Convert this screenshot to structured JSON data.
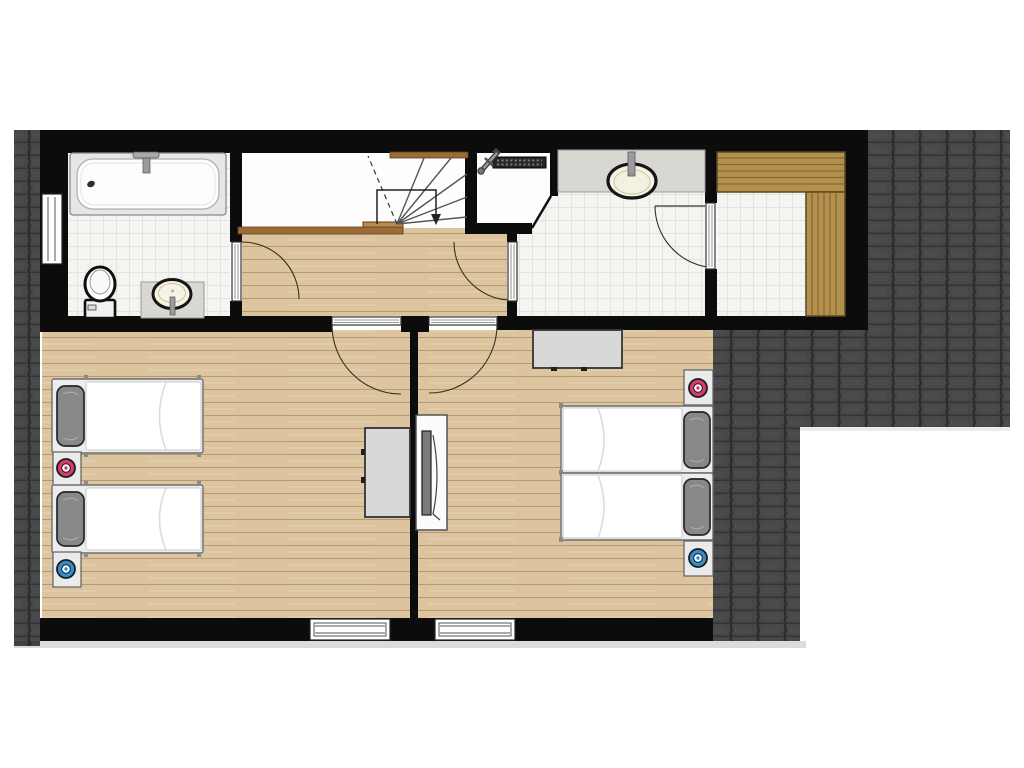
{
  "title": "Upper floor plan",
  "colors": {
    "wall": "#0c0c0c",
    "roof_base": "#474749",
    "roof_gap": "#2c2c2e",
    "roof_row": "#333336",
    "roof_hl": "#4f4f52",
    "wood": "#dcc59e",
    "wood_line": "rgba(110,78,36,0.35)",
    "tile": "#f4f4f1",
    "tile_line": "#e2e2de",
    "floor_white": "#fdfdfd",
    "bench": "#b3904e",
    "bench_line": "#8a6a33",
    "bench_border": "#5c4720",
    "marble": "#d8d7d2",
    "brown": "#9c6c36",
    "brown_light": "#bd8a4e",
    "stair_line": "#555555",
    "door_arc": "#3a2e23",
    "lamp_red": "#d63a6e",
    "lamp_blue": "#2e8fd0",
    "pillow": "#888888",
    "furniture": "#d8d8d8",
    "furniture_stroke": "#333333",
    "tv_screen": "#7a7a7a",
    "fixture_stroke": "#141414"
  },
  "rooms": [
    {
      "id": "bathroom",
      "name": "bathroom",
      "fixtures": [
        "bathtub",
        "toilet",
        "washbasin",
        "vanity-counter",
        "window",
        "door"
      ]
    },
    {
      "id": "stairwell",
      "name": "stairwell",
      "fixtures": [
        "winder-staircase",
        "walk-line",
        "down-arrow",
        "handrail-band",
        "first-tread"
      ]
    },
    {
      "id": "shower-room",
      "name": "shower room",
      "fixtures": [
        "walk-in-shower",
        "shower-mixer",
        "drain-channel",
        "washbasin",
        "vanity-counter",
        "door-to-hall",
        "door-to-sauna"
      ]
    },
    {
      "id": "sauna",
      "name": "sauna",
      "fixtures": [
        "bench-top",
        "bench-right",
        "door"
      ]
    },
    {
      "id": "hallway",
      "name": "hallway",
      "fixtures": [
        "stair-threshold",
        "bathroom-door",
        "shower-room-door",
        "bedroom-left-door",
        "bedroom-right-door"
      ]
    },
    {
      "id": "bedroom-left",
      "name": "bedroom left",
      "fixtures": [
        "single-bed",
        "single-bed",
        "nightstand-red-lamp",
        "nightstand-blue-lamp",
        "desk",
        "window"
      ]
    },
    {
      "id": "bedroom-right",
      "name": "bedroom right",
      "fixtures": [
        "single-bed",
        "single-bed",
        "nightstand-red-lamp",
        "nightstand-blue-lamp",
        "desk",
        "tv-board",
        "window"
      ]
    }
  ],
  "exterior": {
    "areas": [
      "roof-tiles-left-strip",
      "roof-tiles-right-area"
    ]
  }
}
